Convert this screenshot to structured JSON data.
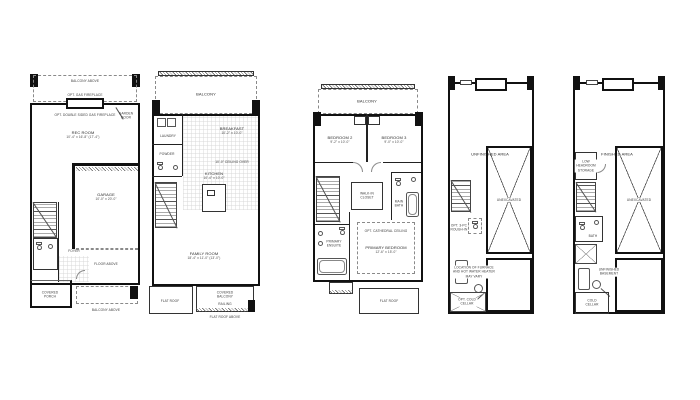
{
  "colors": {
    "ink": "#111111",
    "line": "#555555",
    "dashed": "#8a8a8a",
    "text": "#2a2a2a",
    "background": "#ffffff"
  },
  "plan1": {
    "balcony_above": "BALCONY ABOVE",
    "opt_gas_fireplace": "OPT. GAS FIREPLACE",
    "opt_double_fireplace": "OPT. DOUBLE SIDED GAS FIREPLACE",
    "garden_door": "GARDEN\nDOOR",
    "rec_room": "REC ROOM",
    "rec_room_dims": "10'-4\" x 16'-8\" (17'-4\")",
    "garage": "GARAGE",
    "garage_dims": "10'-0\" x 20'-0\"",
    "foyer": "FOYER",
    "covered_porch": "COVERED\nPORCH",
    "floor_above": "FLOOR ABOVE",
    "balcony_above_lower": "BALCONY ABOVE"
  },
  "plan2": {
    "railing": "RAILING",
    "balcony": "BALCONY",
    "laundry": "LAUNDRY",
    "powder": "POWDER",
    "breakfast": "BREAKFAST",
    "breakfast_dims": "10'-2\" x 10'-0\"",
    "ceiling_note": "10'-0\" CEILING OVER",
    "kitchen": "KITCHEN",
    "kitchen_dims": "10'-4\" x 10'-0\"",
    "family_room": "FAMILY ROOM",
    "family_room_dims": "18'-4\" x 11'-0\" (13'-0\")",
    "flat_roof": "FLAT ROOF",
    "covered_balcony": "COVERED\nBALCONY",
    "flat_roof_above": "FLAT ROOF ABOVE"
  },
  "plan3": {
    "balcony": "BALCONY",
    "bedroom2": "BEDROOM 2",
    "bedroom2_dims": "9'-2\" x 10'-0\"",
    "bedroom3": "BEDROOM 3",
    "bedroom3_dims": "9'-0\" x 10'-0\"",
    "main_bath": "MAIN\nBATH",
    "walk_in_closet": "WALK-IN\nCLOSET",
    "primary_ensuite": "PRIMARY\nENSUITE",
    "ceiling_note": "OPT. CATHEDRAL CEILING",
    "primary_bedroom": "PRIMARY BEDROOM",
    "primary_bedroom_dims": "12'-6\" x 15'-0\"",
    "flat_roof": "FLAT ROOF"
  },
  "plan4": {
    "unfinished_area": "UNFINISHED AREA",
    "unexcavated": "UNEXCAVATED",
    "rough_in": "OPT. 3-PC\nROUGH-IN",
    "furnace_note": "LOCATION OF FURNACE\nAND HOT WATER HEATER\nMAY VARY",
    "cold_cellar": "OPT. COLD\nCELLAR"
  },
  "plan5": {
    "finished_area": "FINISHED AREA",
    "unexcavated": "UNEXCAVATED",
    "storage": "LOW\nHEADROOM\nSTORAGE",
    "bath": "BATH",
    "unfinished_basement": "UNFINISHED\nBASEMENT",
    "cold_cellar": "COLD\nCELLAR"
  }
}
